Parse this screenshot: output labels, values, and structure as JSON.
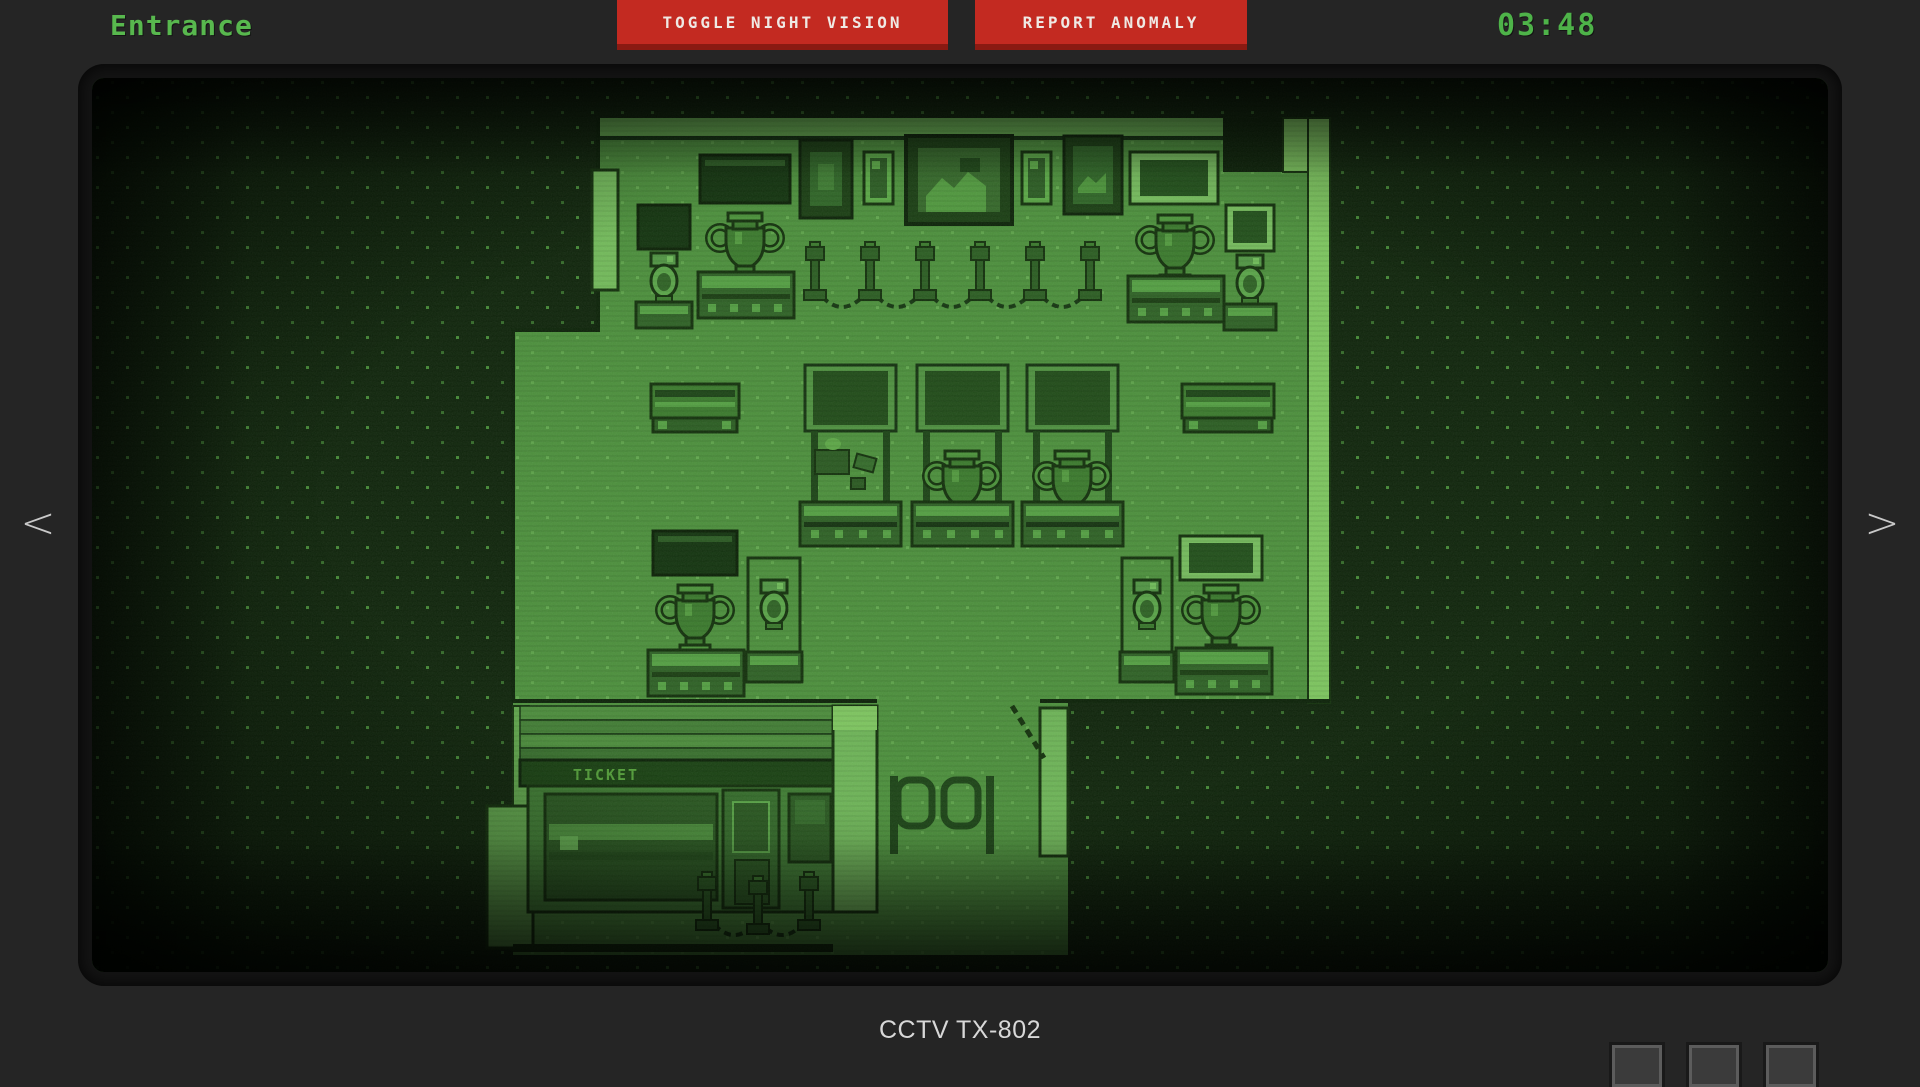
{
  "header": {
    "camera_name": "Entrance",
    "buttons": {
      "toggle_night_vision": "TOGGLE NIGHT VISION",
      "report_anomaly": "REPORT ANOMALY"
    },
    "clock": "03:48"
  },
  "navigation": {
    "prev": "<",
    "next": ">"
  },
  "footer": {
    "camera_id": "CCTV TX-802"
  },
  "scene": {
    "ticket_sign": "TICKET"
  },
  "colors": {
    "ui_green": "#54b44a",
    "button_red": "#c32a21",
    "button_red_shadow": "#8a1a12",
    "nightvision_floor": "#4c8f3c",
    "nightvision_dark": "#10260c",
    "wall_light": "#7cc45e",
    "page_background": "#252525",
    "text_light": "#d8d8d8"
  }
}
